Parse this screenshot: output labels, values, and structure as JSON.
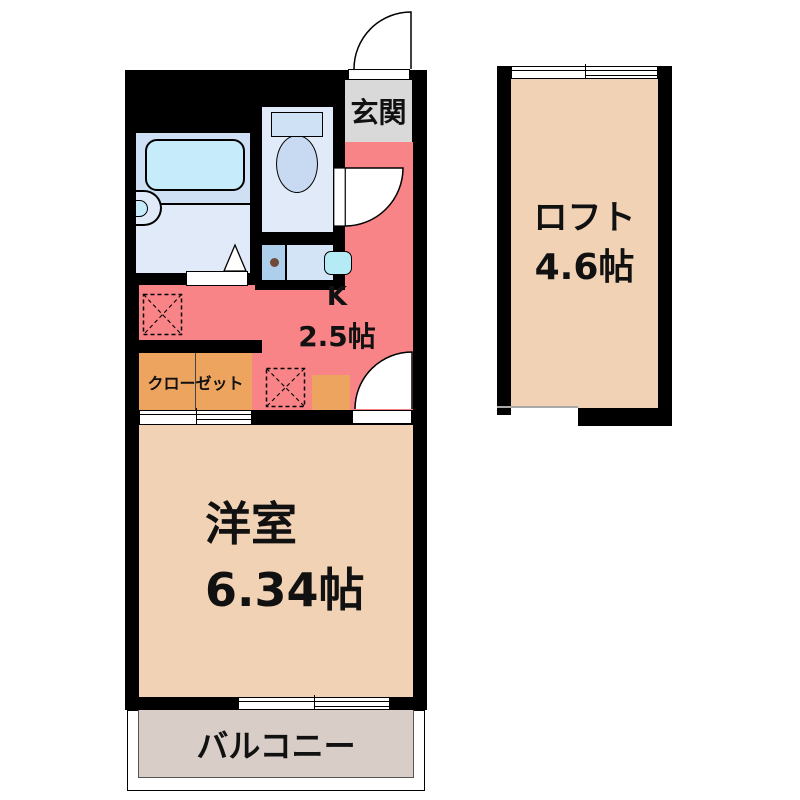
{
  "rooms": {
    "entrance": {
      "label": "玄関"
    },
    "kitchen": {
      "label": "K",
      "size": "2.5帖"
    },
    "closet": {
      "label": "クローゼット"
    },
    "western_room": {
      "label": "洋室",
      "size": "6.34帖"
    },
    "balcony": {
      "label": "バルコニー"
    },
    "loft": {
      "label": "ロフト",
      "size": "4.6帖"
    }
  },
  "colors": {
    "wall": "#000000",
    "kitchen": "#f98487",
    "room": "#f2d2b4",
    "closet": "#eda45e",
    "genkan": "#d9d9d9",
    "balcony": "#d8cdc7",
    "bath_top": "#cfe0f4",
    "bath_bottom": "#e0eaf8",
    "tub": "#c6ebfa",
    "fixture": "#cfe1f4",
    "bowl": "#c8daf2",
    "unit_left": "#aecfeb",
    "unit_right": "#d3e4f6",
    "sink": "#b4ebf4",
    "burner_dot": "#6f4a39",
    "text": "#111111"
  }
}
